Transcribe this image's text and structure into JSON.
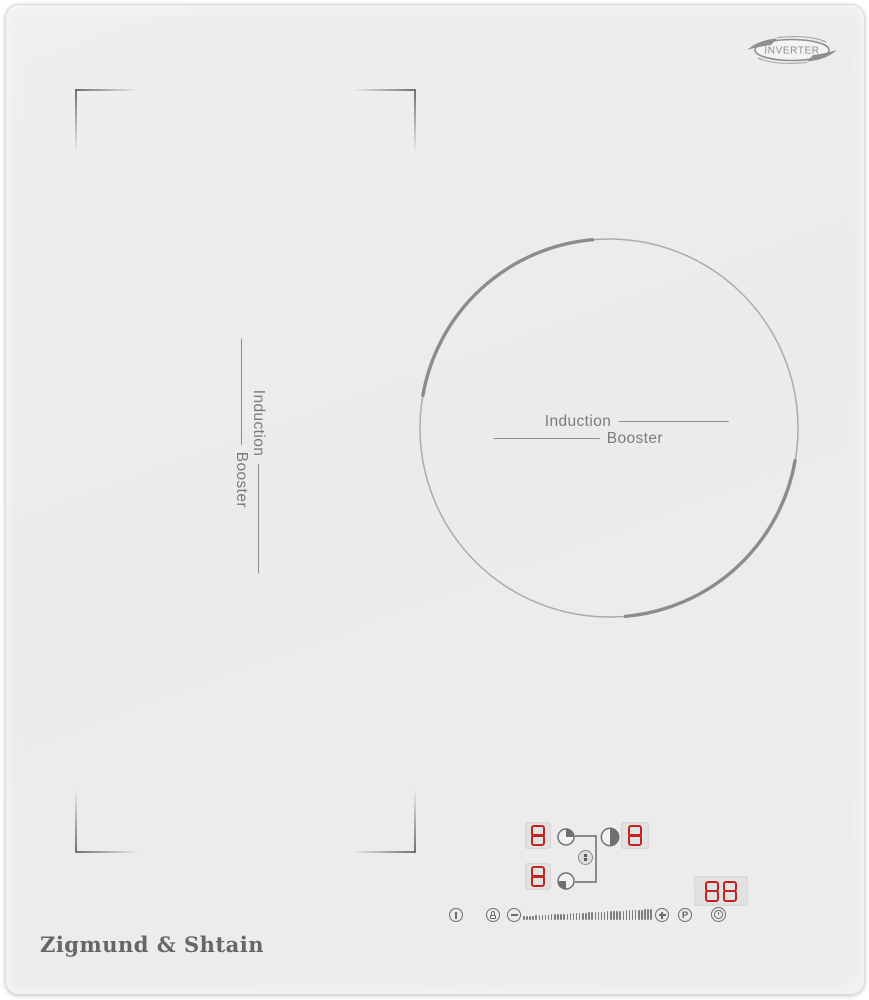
{
  "colors": {
    "surface": "#ededed",
    "line_gray": "#8a8a8a",
    "text_gray": "#7b7b7b",
    "display_bg": "#e2e2e2",
    "segment_red": "#c32222"
  },
  "badge": {
    "label": "INVERTER"
  },
  "zones": {
    "left": {
      "line1": "Induction",
      "line2": "Booster"
    },
    "right": {
      "line1": "Induction",
      "line2": "Booster"
    }
  },
  "control_panel": {
    "displays": [
      {
        "id": "left-rear-power",
        "value": "8"
      },
      {
        "id": "left-front-power",
        "value": "8"
      },
      {
        "id": "right-power",
        "value": "8"
      },
      {
        "id": "timer",
        "value": "88"
      }
    ],
    "buttons": {
      "p_label": "P"
    },
    "slider": {
      "tick_count": 42
    },
    "icons": {
      "power": "circle-with-bar",
      "lock": "circle-with-padlock",
      "minus": "circle-minus",
      "plus": "circle-plus",
      "booster": "circle-letter-P",
      "timer": "circle-clock",
      "left_rear_zone": "circle-quarter-filled-top-right",
      "left_front_zone": "circle-quarter-filled-bottom-left",
      "bridge": "circle-two-squares",
      "right_zone": "circle-half-filled-right"
    }
  },
  "brand": {
    "name": "Zigmund & Shtain"
  }
}
